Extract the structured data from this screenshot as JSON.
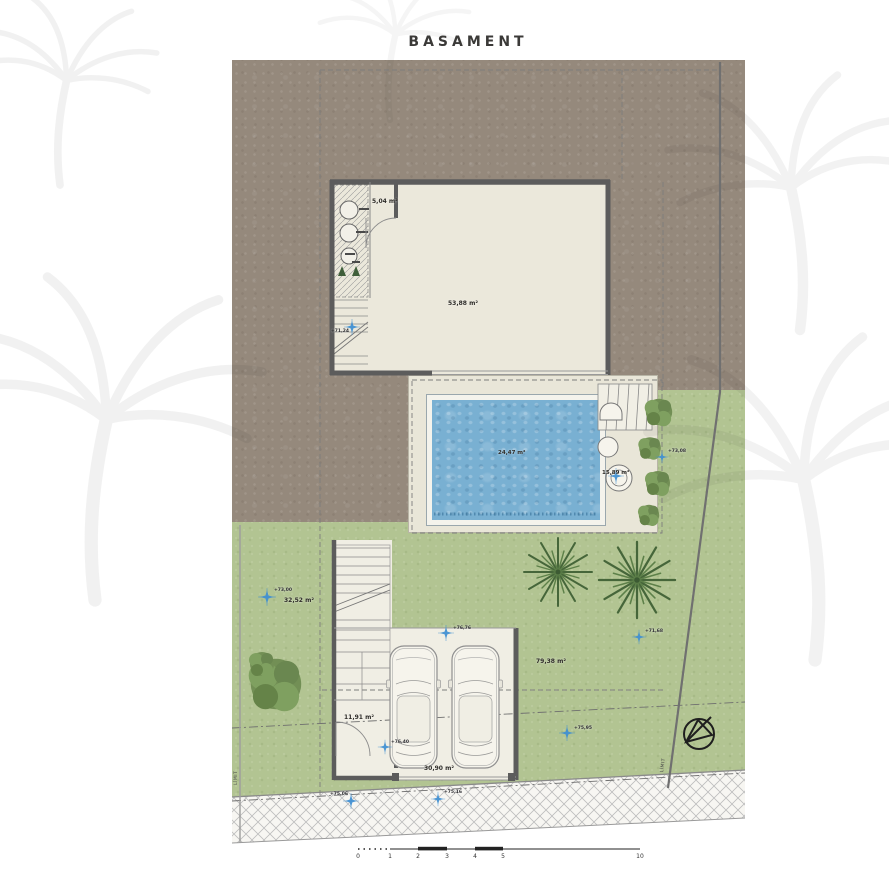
{
  "title": "BASAMENT",
  "site": {
    "rooms": [
      {
        "id": "technical-room",
        "area": "5,04 m²"
      },
      {
        "id": "main-room",
        "area": "53,88 m²"
      },
      {
        "id": "pool",
        "area": "24,47 m²"
      },
      {
        "id": "pool-deck",
        "area": "15,89 m²"
      },
      {
        "id": "side-yard",
        "area": "32,52 m²"
      },
      {
        "id": "back-yard",
        "area": "79,38 m²"
      },
      {
        "id": "entry",
        "area": "11,91 m²"
      },
      {
        "id": "carport",
        "area": "30,90 m²"
      }
    ],
    "levels": [
      {
        "label": "+71,24"
      },
      {
        "label": "+73,08"
      },
      {
        "label": "+73,00"
      },
      {
        "label": "+76,76"
      },
      {
        "label": "+71,68"
      },
      {
        "label": "+75,95"
      },
      {
        "label": "+76,40"
      },
      {
        "label": "+75,06"
      },
      {
        "label": "+75,16"
      }
    ],
    "boundaries": [
      {
        "label": "LÍMIT"
      },
      {
        "label": "LÍMIT"
      }
    ],
    "scalebar": {
      "unit_labels": [
        "0",
        "1",
        "2",
        "3",
        "4",
        "5",
        "10"
      ]
    }
  },
  "colors": {
    "earth": "#95897c",
    "grass": "#b2c492",
    "pool_water": "#79b0d2",
    "wall": "#5c5c5c",
    "interior": "#ebe8db",
    "marker_blue": "#3f8fd2",
    "title_text": "#3b3a38"
  }
}
